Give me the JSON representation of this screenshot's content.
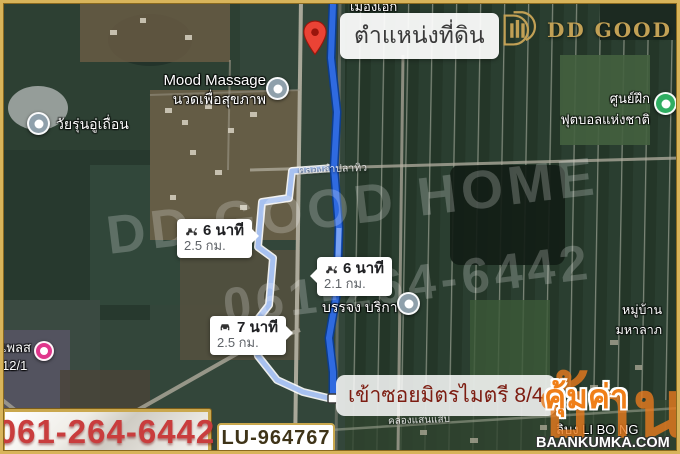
{
  "brand": {
    "logo_text": "DD GOOD HOME"
  },
  "watermark": {
    "line1": "DD GOOD HOME",
    "line2": "061-264-6442"
  },
  "pin": {
    "label": "ตำแหน่งที่ดิน"
  },
  "pois": {
    "town": {
      "name": "เมืองเอก"
    },
    "mood": {
      "name": "Mood Massage",
      "sub": "นวดเพื่อสุขภาพ"
    },
    "garage": {
      "name": "วัยรุ่นอู่เถื่อน"
    },
    "football": {
      "name": "ศูนย์ฝึก",
      "sub": "ฟุตบอลแห่งชาติ"
    },
    "banjong": {
      "name": "บรรจง บริการ"
    },
    "village": {
      "name": "หมู่บ้าน",
      "sub": "มหาลาภ"
    },
    "place": {
      "name": "เพลส",
      "sub": "12/1"
    },
    "libong": {
      "name": "ลิบง LI BO NG"
    },
    "canal_top": {
      "name": "คลองลำปลาทิว"
    },
    "canal_bottom": {
      "name": "คลองแสนแสบ"
    }
  },
  "routes": [
    {
      "mode": "scooter",
      "duration": "6 นาที",
      "distance": "2.5 กม."
    },
    {
      "mode": "scooter",
      "duration": "6 นาที",
      "distance": "2.1 กม."
    },
    {
      "mode": "car",
      "duration": "7 นาที",
      "distance": "2.5 กม."
    }
  ],
  "entry": {
    "label": "เข้าซอยมิตรไมตรี 8/4"
  },
  "footer": {
    "phone": "061-264-6442",
    "listing_code": "LU-964767"
  },
  "site_watermark": {
    "thai_big": "บ้าน",
    "thai_accent": "คุ้มค่า",
    "domain": "BAANKUMKA.COM"
  },
  "colors": {
    "frame_gold": "#d8b45a",
    "logo_gold": "#c2a055",
    "route_blue": "#2f6ae0",
    "alt_route_blue": "#a7c1f0",
    "pin_red": "#ea4335",
    "phone_red": "#c93d3d",
    "entry_red": "#7d1d12",
    "watermark_orange": "#f07f18"
  }
}
